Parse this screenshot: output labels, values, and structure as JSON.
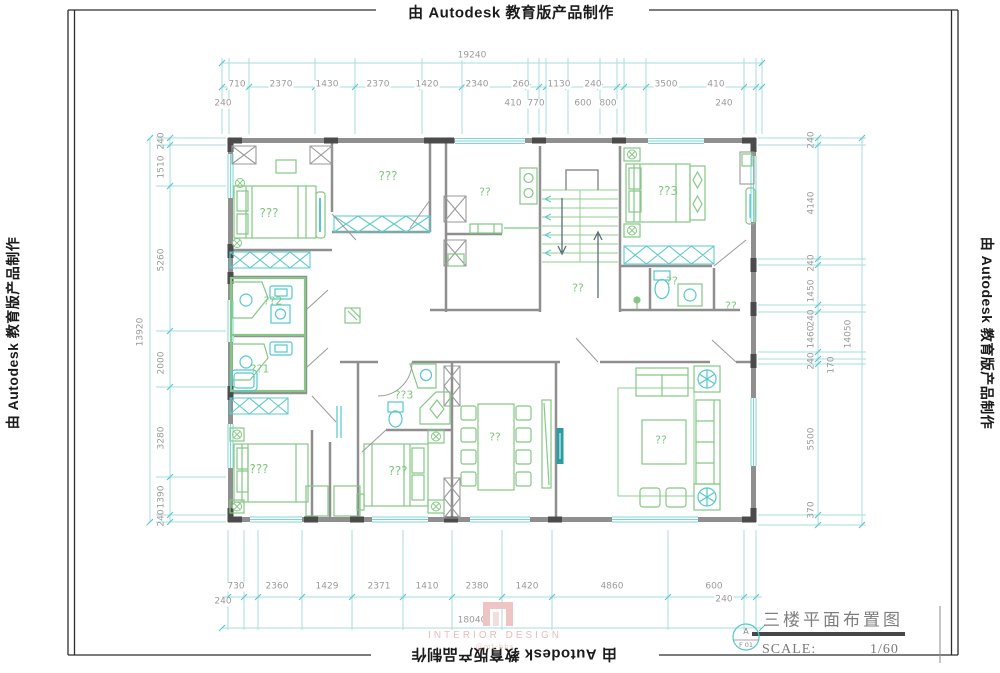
{
  "watermark": {
    "text": "由 Autodesk 教育版产品制作"
  },
  "title_block": {
    "title": "三楼平面布置图",
    "scale_label": "SCALE:",
    "scale_value": "1/60",
    "ref_letter": "A",
    "ref_code": "F 01"
  },
  "logo": {
    "brand": "INTERIOR DESIGN",
    "handle": "@mt-bbs"
  },
  "colors": {
    "wall_gray": "#8f8f8f",
    "pier_dark": "#4b4b4b",
    "furniture_green": "#85c885",
    "fixture_cyan": "#55c8cc",
    "dimension_cyan": "#a8dede",
    "dim_text_gray": "#9b9b9b",
    "label_green": "#7cc87c",
    "logo_pink": "#efc4c4"
  },
  "dimensions": {
    "top": {
      "total": "19240",
      "row": [
        "710",
        "2370",
        "1430",
        "2370",
        "1420",
        "2340",
        "260",
        "1130",
        "240",
        "3500",
        "410"
      ],
      "sub": [
        "240",
        "410",
        "770",
        "600",
        "800",
        "240"
      ]
    },
    "left": {
      "total": "13920",
      "column": [
        "240",
        "1510",
        "5260",
        "2000",
        "3280",
        "1390",
        "240"
      ]
    },
    "right": {
      "total": "14050",
      "column": [
        "240",
        "4140",
        "240",
        "1450",
        "240",
        "1460",
        "240",
        "170",
        "5500",
        "370"
      ]
    },
    "bottom": {
      "total": "18040",
      "row": [
        "730",
        "2360",
        "1429",
        "2371",
        "1410",
        "2380",
        "1420",
        "4860",
        "600"
      ],
      "left_end": "240",
      "right_end": "240"
    }
  },
  "rooms": {
    "bedroom_top_left": "???",
    "closet_room": "???",
    "kitchen": "??",
    "bath_2": "??2",
    "bath_1": "??1",
    "stair_hall": "??",
    "bedroom_top_right": "??3",
    "bath_right": "??",
    "hall_right": "??",
    "bath_3": "??3",
    "bedroom_mid": "???",
    "bedroom_bottom_left": "???",
    "dining": "??",
    "living": "??"
  }
}
